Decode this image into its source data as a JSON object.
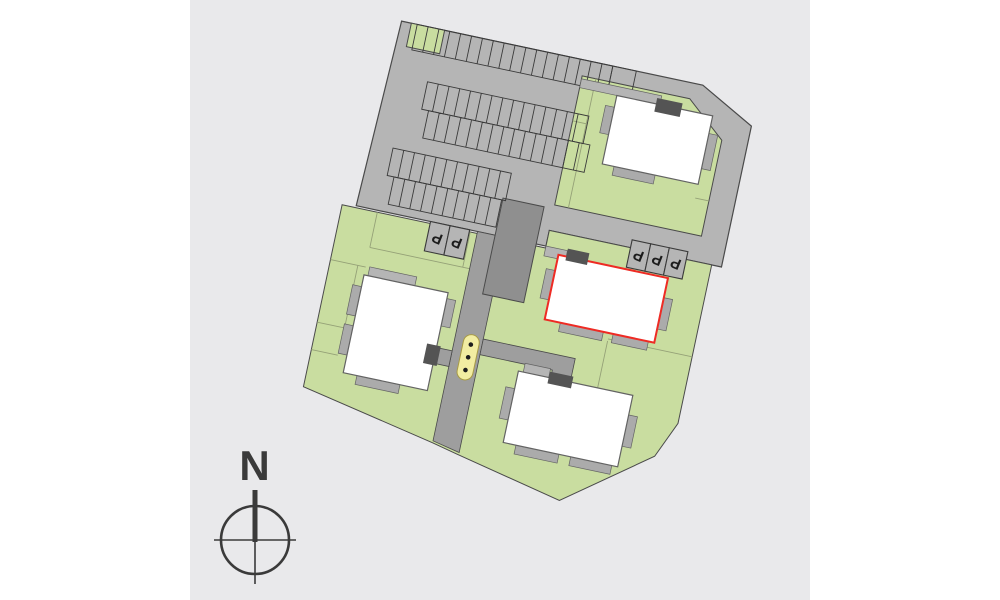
{
  "page": {
    "background": "#ffffff",
    "canvas_background": "#e9e9eb"
  },
  "site_plan": {
    "rotation_deg": 12,
    "colors": {
      "panel": "#e9e9eb",
      "pavement": "#b5b5b5",
      "road": "#9e9e9e",
      "green": "#c9dda0",
      "greenline": "#95a177",
      "garage": "#8f8f8f",
      "building": "#ffffff",
      "buildingline": "#636363",
      "balcony": "#ababab",
      "entrance": "#545454",
      "outline": "#4a4a4a",
      "stall": "#3a3a3a",
      "highlight": "#ee2b24",
      "playground": "#f2eda2",
      "playline": "#a89b45",
      "compass": "#3a3a3a"
    },
    "buildings": [
      {
        "id": "building-north-east",
        "highlighted": false
      },
      {
        "id": "building-east-highlighted",
        "highlighted": true
      },
      {
        "id": "building-west",
        "highlighted": false
      },
      {
        "id": "building-south",
        "highlighted": false
      }
    ],
    "parking": {
      "marker_label": "P",
      "lot_stall_rows": [
        18,
        1,
        15,
        15,
        11,
        10
      ],
      "marked_groups": [
        {
          "id": "west",
          "count": 2
        },
        {
          "id": "east",
          "count": 3
        }
      ]
    },
    "features": {
      "underground_garage": "dark-grey-block",
      "playground_marker": "yellow-pill-three-dots"
    }
  },
  "compass": {
    "north_label": "N"
  }
}
